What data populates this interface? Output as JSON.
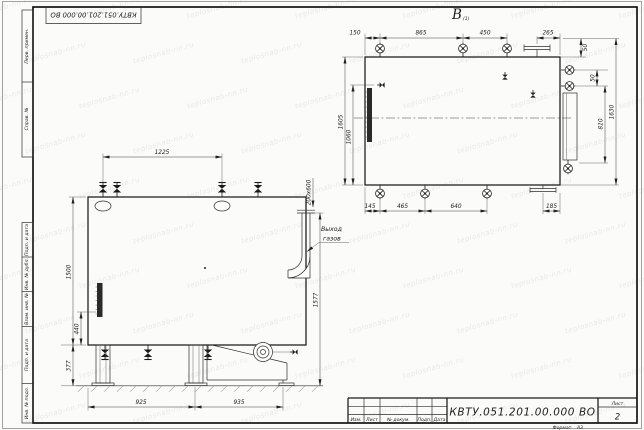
{
  "doc": {
    "designation": "КВТУ.051.201.00.000 ВО",
    "format_label": "Формат",
    "format_value": "А3"
  },
  "stamp": {
    "designation": "КВТУ.051.201.00.000 ВО",
    "col_izm": "Изм.",
    "col_list": "Лист",
    "col_doc": "№ докум.",
    "col_podp": "Подп.",
    "col_data": "Дата",
    "sheet_label": "Лист",
    "sheet_number": "2"
  },
  "margin": {
    "perv": "Перв. примен.",
    "sprav": "Справ. №",
    "podp1": "Подп. и дата",
    "inv_dubl": "Инв. № дубл.",
    "vzam": "Взам. инв. №",
    "podp2": "Подп. и дата",
    "inv_podl": "Инв. № подл."
  },
  "front": {
    "dim_top": "1225",
    "dim_height": "1500",
    "dim_mid": "440",
    "dim_leg": "377",
    "dim_bottom_left": "925",
    "dim_bottom_right": "935",
    "dim_right": "1577",
    "dim_duct": "200х600",
    "gas_line1": "Выход",
    "gas_line2": "газов"
  },
  "top": {
    "label": "В",
    "label_sub": "(1)",
    "d150": "150",
    "d865": "865",
    "d450": "450",
    "d265": "265",
    "d145": "145",
    "d465": "465",
    "d640": "640",
    "d185": "185",
    "d1605": "1605",
    "d1060": "1060",
    "d50a": "50",
    "d50b": "50",
    "d810": "810",
    "d1630": "1630"
  },
  "watermark": {
    "text": "teplosnab-nn.ru"
  }
}
